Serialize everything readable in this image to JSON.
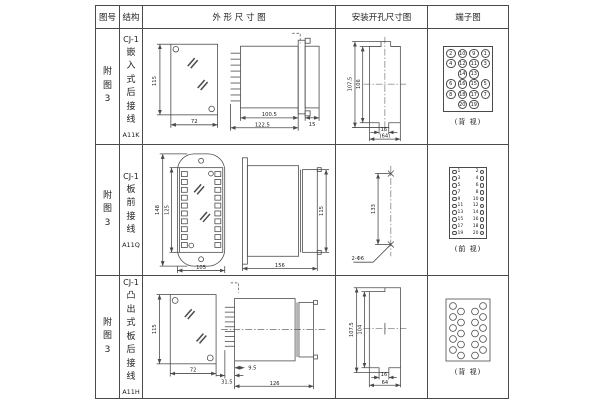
{
  "header": {
    "figure": "图号",
    "structure": "结构",
    "outline": "外 形 尺 寸 图",
    "mounting": "安装开孔尺寸图",
    "terminal": "端子图"
  },
  "rows": [
    {
      "figure": "附图3",
      "model": "CJ-1",
      "structure": "嵌入式后接线",
      "code": "A11K",
      "outline": {
        "front_h": "115",
        "front_w": "72",
        "body_len": "100.5",
        "total_len": "122.5",
        "front_d": "15"
      },
      "mounting": {
        "outer_h": "107.5",
        "inner_h": "106",
        "notch_w": "16",
        "cut_w": "(64)"
      },
      "terminal": {
        "view": "(背 视)",
        "grid": [
          [
            "2",
            "10",
            "9",
            "1"
          ],
          [
            "4",
            "12",
            "11",
            "3"
          ],
          [
            "",
            "14",
            "13",
            ""
          ],
          [
            "6",
            "16",
            "15",
            "5"
          ],
          [
            "8",
            "18",
            "17",
            "7"
          ],
          [
            "",
            "20",
            "19",
            ""
          ]
        ]
      }
    },
    {
      "figure": "附图3",
      "model": "CJ-1",
      "structure": "板前接线",
      "code": "A11Q",
      "outline": {
        "plate_h": "148",
        "body_h": "125",
        "plate_w": "105",
        "total_len": "156",
        "rear_h": "115"
      },
      "mounting": {
        "pitch": "133",
        "holes": "2-Φ6"
      },
      "terminal": {
        "view": "(前 视)",
        "left": [
          "1",
          "3",
          "5",
          "7",
          "9",
          "11",
          "13",
          "15",
          "17",
          "19"
        ],
        "right": [
          "2",
          "4",
          "6",
          "8",
          "10",
          "12",
          "14",
          "16",
          "18",
          "20"
        ]
      }
    },
    {
      "figure": "附图3",
      "model": "CJ-1",
      "structure": "凸出式板后接线",
      "code": "A11H",
      "outline": {
        "front_h": "115",
        "front_w": "72",
        "stud_len": "31.5",
        "offset": "9.5",
        "body_len": "126"
      },
      "mounting": {
        "outer_h": "107.5",
        "inner_h": "104",
        "notch_w": "16",
        "cut_w": "64"
      },
      "terminal": {
        "view": "(背 视)"
      }
    }
  ]
}
